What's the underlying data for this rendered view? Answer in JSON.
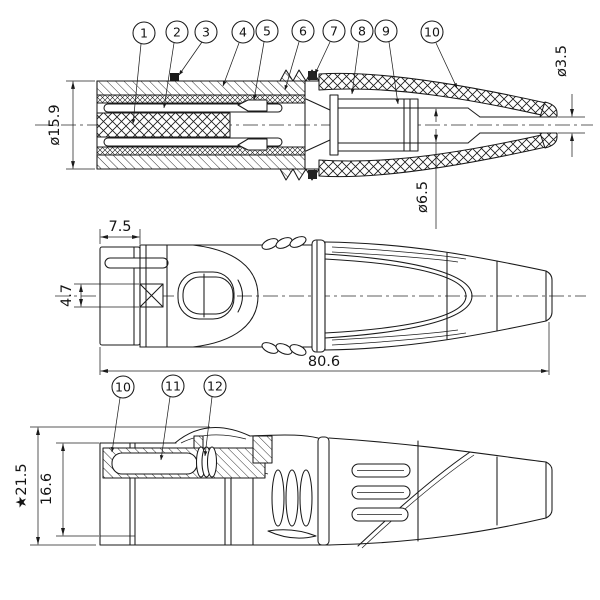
{
  "colors": {
    "background": "#ffffff",
    "line": "#1a1a1a"
  },
  "section_view": {
    "callouts": [
      "1",
      "2",
      "3",
      "4",
      "5",
      "6",
      "7",
      "8",
      "9",
      "10"
    ],
    "dim_body_diameter": "ø15.9",
    "dim_cable_exit_diameter": "ø3.5",
    "dim_bore_diameter": "ø6.5"
  },
  "side_view": {
    "dim_rear_depth": "7.5",
    "dim_latch_slot_height": "4.7",
    "dim_overall_length": "80.6"
  },
  "bottom_view": {
    "callouts": [
      "10",
      "11",
      "12"
    ],
    "dim_overall_height": "★21.5",
    "dim_shell_height": "16.6"
  }
}
